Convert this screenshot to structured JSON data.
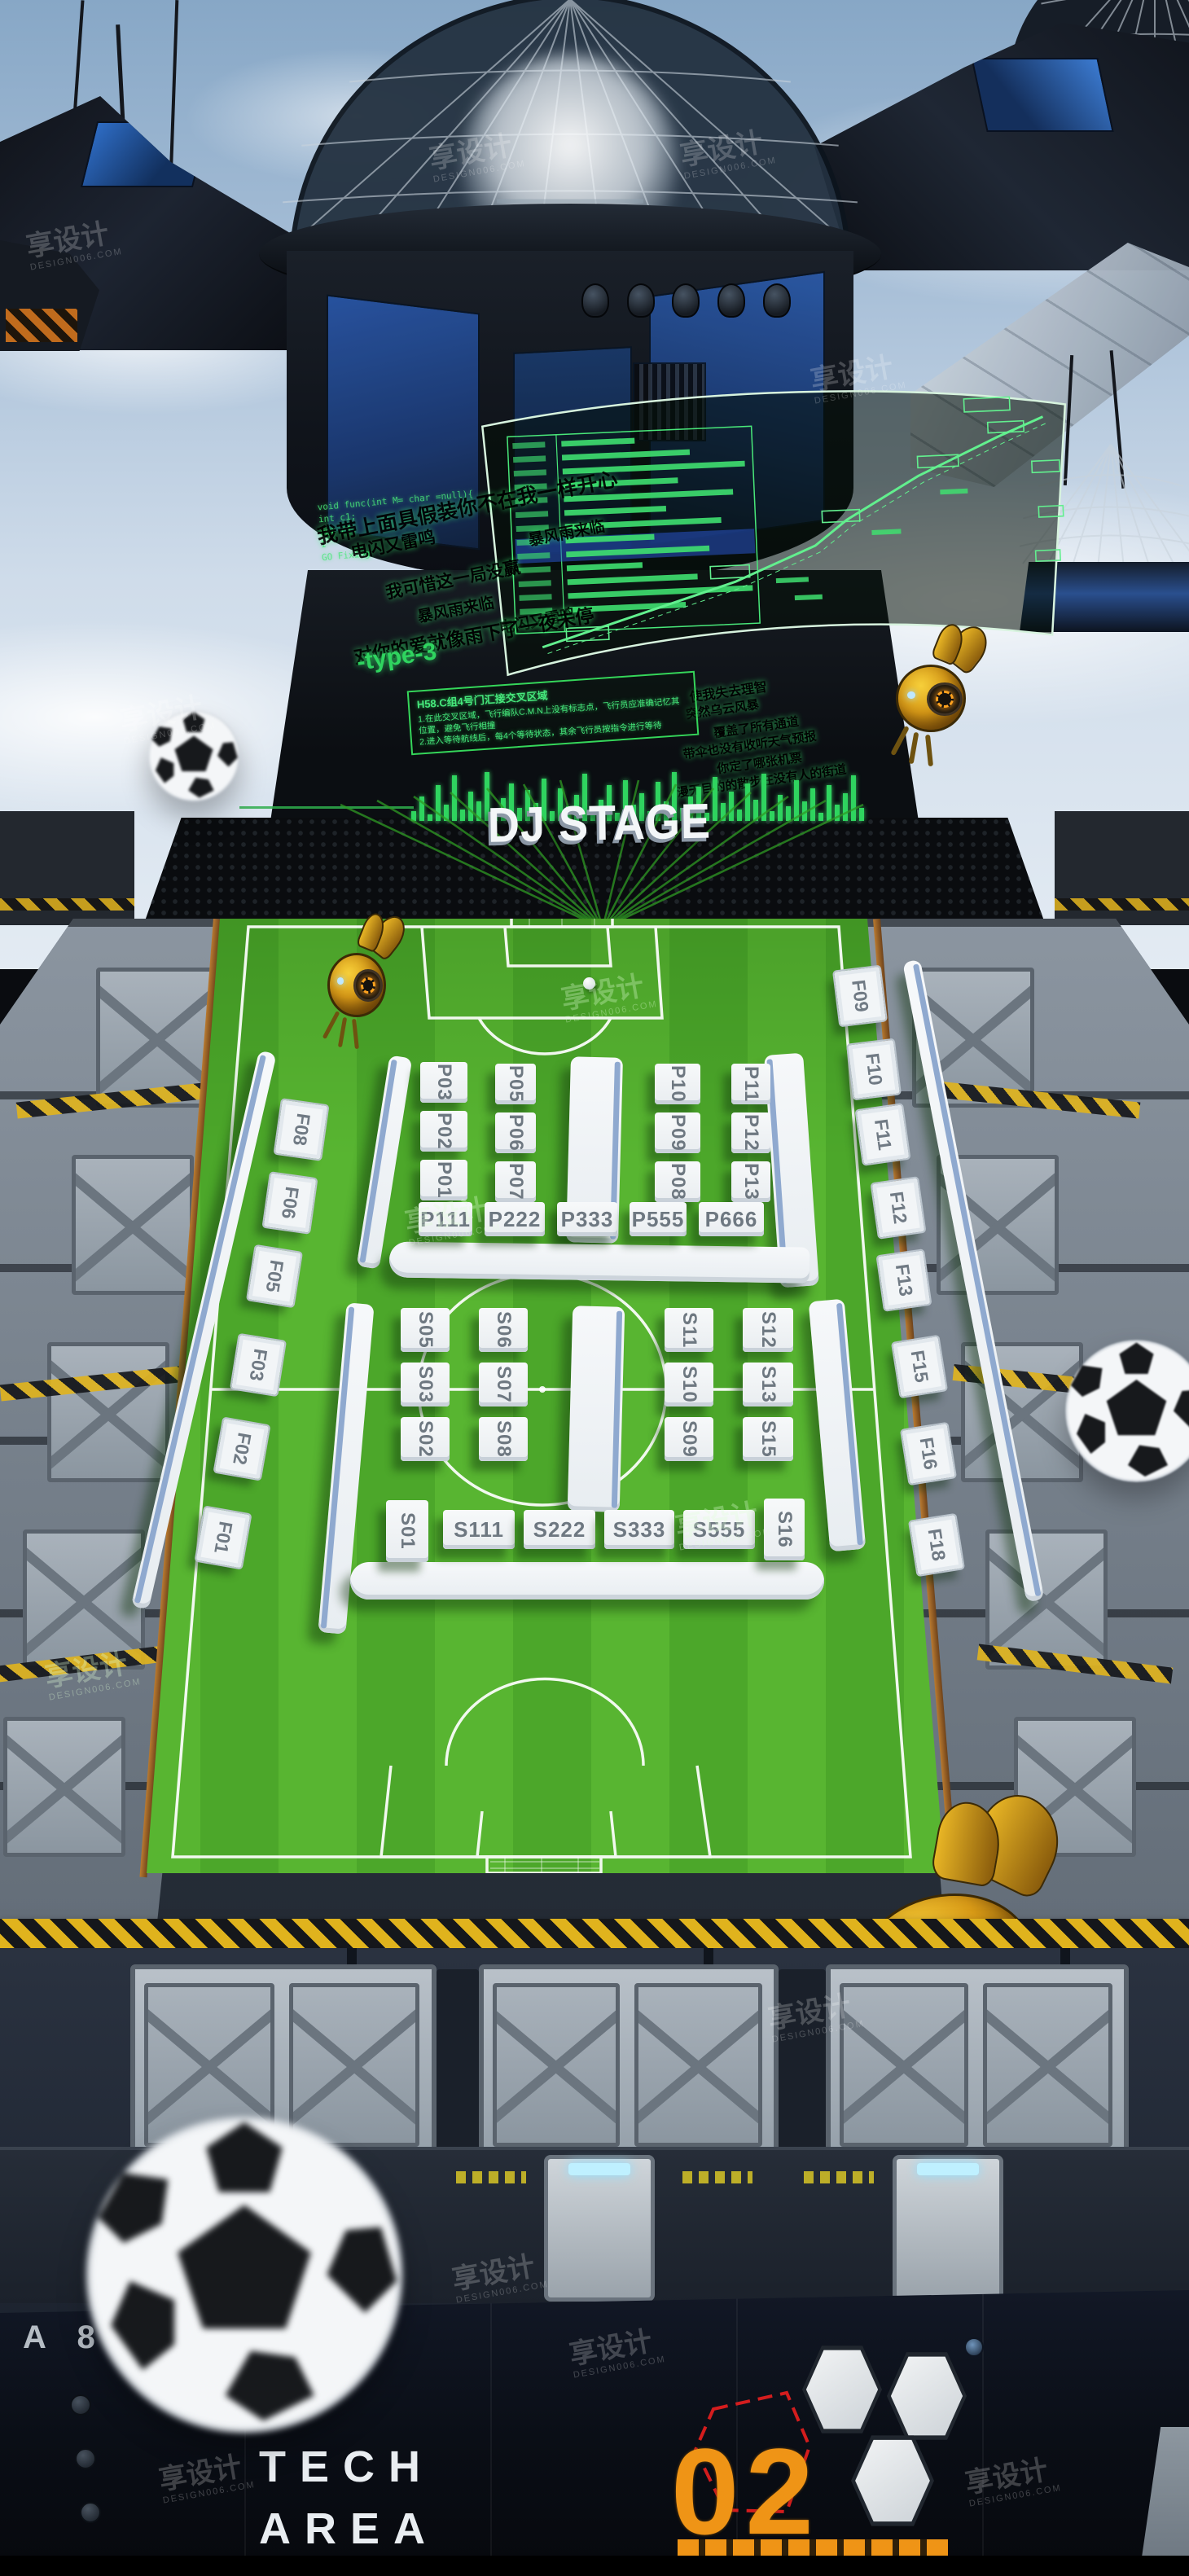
{
  "watermark": {
    "cn": "享设计",
    "en": "DESIGN006.COM"
  },
  "stage": {
    "title": "DJ STAGE"
  },
  "holo": {
    "code": "void func(int M= char =null){\n int c1;\n ret c1;\n 1\nGO Fixing",
    "lyrics_left": [
      "我带上面具假装你不在我一样开心",
      "暴风雨来临",
      "电闪又雷鸣",
      "我可惜这一局没赢",
      "暴风雨来临",
      "电闪又雷鸣",
      "对你的爱就像雨下了一夜未停"
    ],
    "type_label": "-type-3",
    "infobox": {
      "title": "H58.C组4号门汇接交叉区域",
      "l1": "1.在此交叉区域，飞行编队C.M.N上没有标志点，飞行员应准确记忆其位置，避免飞行相撞",
      "l2": "2.进入等待航线后，每4个等待状态，其余飞行员按指令进行等待"
    },
    "lyrics_right": [
      "使我失去理智",
      "突然乌云风暴",
      "覆盖了所有通道",
      "带伞也没有收听天气预报",
      "你定了哪张机票",
      "漫无目的的散步在没有人的街道"
    ],
    "equalizer_bars": [
      12,
      30,
      8,
      44,
      20,
      56,
      14,
      36,
      24,
      60,
      10,
      28,
      46,
      16,
      38,
      22,
      52,
      12,
      40,
      18,
      32,
      58,
      14,
      26,
      44,
      10,
      50,
      20,
      34,
      12,
      48,
      24,
      60,
      16,
      30,
      42,
      10,
      54,
      22,
      36,
      14,
      46,
      26,
      58,
      12,
      32,
      18,
      50,
      24,
      40,
      10,
      44,
      20,
      34,
      56,
      16
    ]
  },
  "field": {
    "upper": {
      "columns": [
        [
          "P03",
          "P02",
          "P01"
        ],
        [
          "P05",
          "P06",
          "P07"
        ],
        [
          "P10",
          "P09",
          "P08"
        ],
        [
          "P11",
          "P12",
          "P13"
        ]
      ],
      "front_row": [
        "P111",
        "P222",
        "P333",
        "P555",
        "P666"
      ]
    },
    "lower": {
      "columns": [
        [
          "S05",
          "S03",
          "S02"
        ],
        [
          "S06",
          "S07",
          "S08"
        ],
        [
          "S11",
          "S10",
          "S09"
        ],
        [
          "S12",
          "S13",
          "S15"
        ]
      ],
      "front_row": [
        "S111",
        "S222",
        "S333",
        "S555"
      ],
      "side_left": "S01",
      "side_right": "S16"
    },
    "f_left": [
      "F08",
      "F06",
      "F05",
      "F03",
      "F02",
      "F01"
    ],
    "f_right": [
      "F09",
      "F10",
      "F11",
      "F12",
      "F13",
      "F15",
      "F16",
      "F18"
    ]
  },
  "bottom": {
    "sector_label": "A 8",
    "tech_line1": "TECH",
    "tech_line2": "AREA",
    "zone_number": "02"
  },
  "colors": {
    "field_green": "#58b531",
    "holo_green": "#3be06b",
    "accent_orange": "#ef9416",
    "alert_red": "#e61e1e",
    "booth_white": "#f5f7f9"
  }
}
